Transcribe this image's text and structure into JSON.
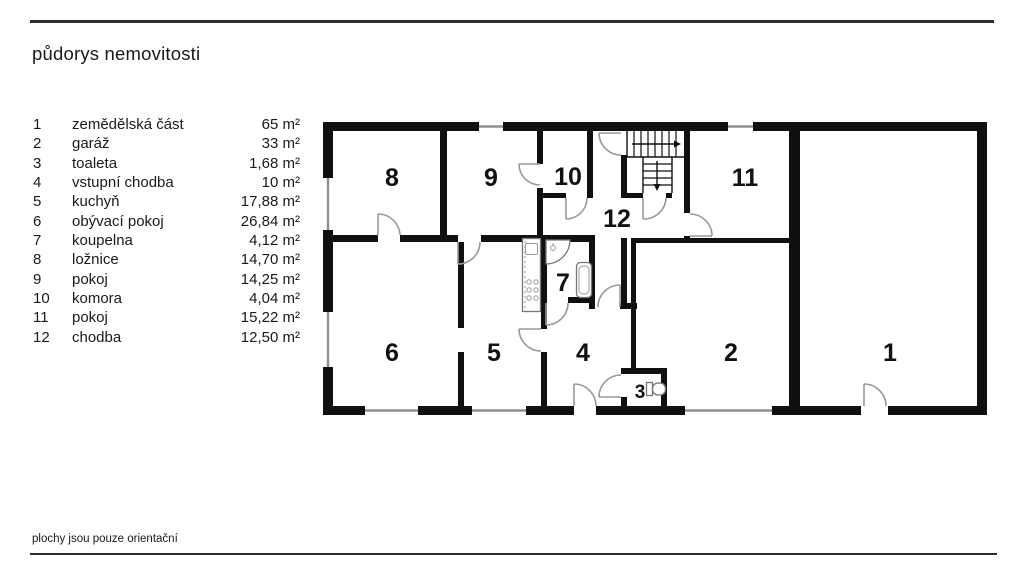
{
  "title": "půdorys nemovitosti",
  "footer": "plochy jsou pouze orientační",
  "legend": {
    "items": [
      {
        "num": "1",
        "name": "zemědělská část",
        "area": "65 m²"
      },
      {
        "num": "2",
        "name": "garáž",
        "area": "33 m²"
      },
      {
        "num": "3",
        "name": "toaleta",
        "area": "1,68 m²"
      },
      {
        "num": "4",
        "name": "vstupní chodba",
        "area": "10 m²"
      },
      {
        "num": "5",
        "name": "kuchyň",
        "area": "17,88 m²"
      },
      {
        "num": "6",
        "name": "obývací pokoj",
        "area": "26,84 m²"
      },
      {
        "num": "7",
        "name": "koupelna",
        "area": "4,12 m²"
      },
      {
        "num": "8",
        "name": "ložnice",
        "area": "14,70 m²"
      },
      {
        "num": "9",
        "name": "pokoj",
        "area": "14,25 m²"
      },
      {
        "num": "10",
        "name": "komora",
        "area": "4,04 m²"
      },
      {
        "num": "11",
        "name": "pokoj",
        "area": "15,22 m²"
      },
      {
        "num": "12",
        "name": "chodba",
        "area": "12,50 m²"
      }
    ]
  },
  "plan": {
    "rooms": [
      "1",
      "2",
      "3",
      "4",
      "5",
      "6",
      "7",
      "8",
      "9",
      "10",
      "11",
      "12"
    ]
  },
  "colors": {
    "wall": "#101010",
    "door_arc": "#9a9a9a",
    "window": "#8f8f8f",
    "text": "#1a1a1a"
  }
}
